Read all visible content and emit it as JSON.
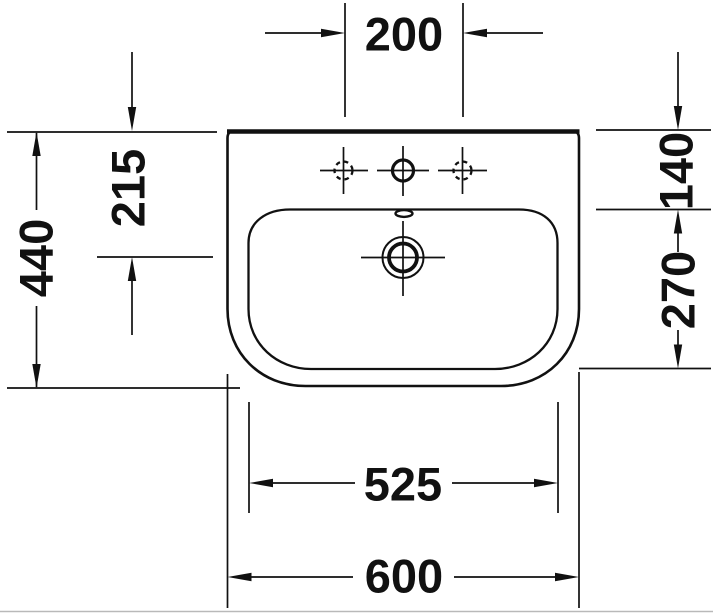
{
  "figure": {
    "kind": "sanitary-ware technical drawing, washbasin top view",
    "units": "mm",
    "colors": {
      "ink": "#111111",
      "background": "#ffffff",
      "page_edge": "#b9b9b9"
    },
    "dims": {
      "tap_hole_spacing": "200",
      "overall_depth": "440",
      "back_edge_to_drain_center": "215",
      "back_edge_to_bowl_front": "140",
      "bowl_depth": "270",
      "bowl_width": "525",
      "overall_width": "600"
    }
  }
}
